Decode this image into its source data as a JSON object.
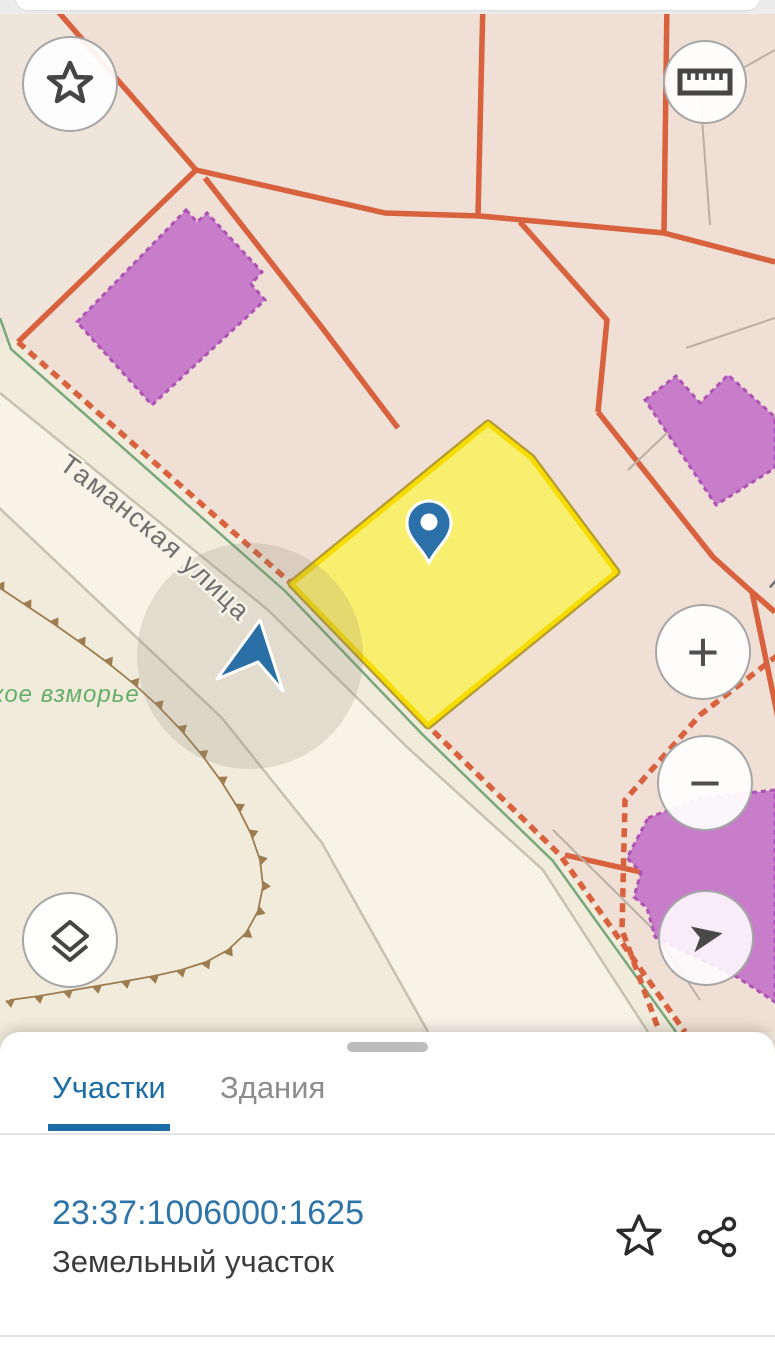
{
  "map": {
    "street_label": "Таманская улица",
    "street_label_edge": "Та",
    "area_label": "кое взморье",
    "colors": {
      "parcel_boundary": "#d8613e",
      "selected_parcel_fill": "#f9ef6e",
      "selected_parcel_border": "#f6dc00",
      "building_fill": "#c77dc9",
      "pin_blue": "#2b70a9",
      "accent_blue": "#1c6ca8"
    }
  },
  "controls": {
    "zoom_in_label": "+",
    "zoom_out_label": "−"
  },
  "bottom_sheet": {
    "tabs": [
      {
        "label": "Участки",
        "active": true
      },
      {
        "label": "Здания",
        "active": false
      }
    ],
    "result": {
      "cadastral_number": "23:37:1006000:1625",
      "type_label": "Земельный участок"
    }
  }
}
